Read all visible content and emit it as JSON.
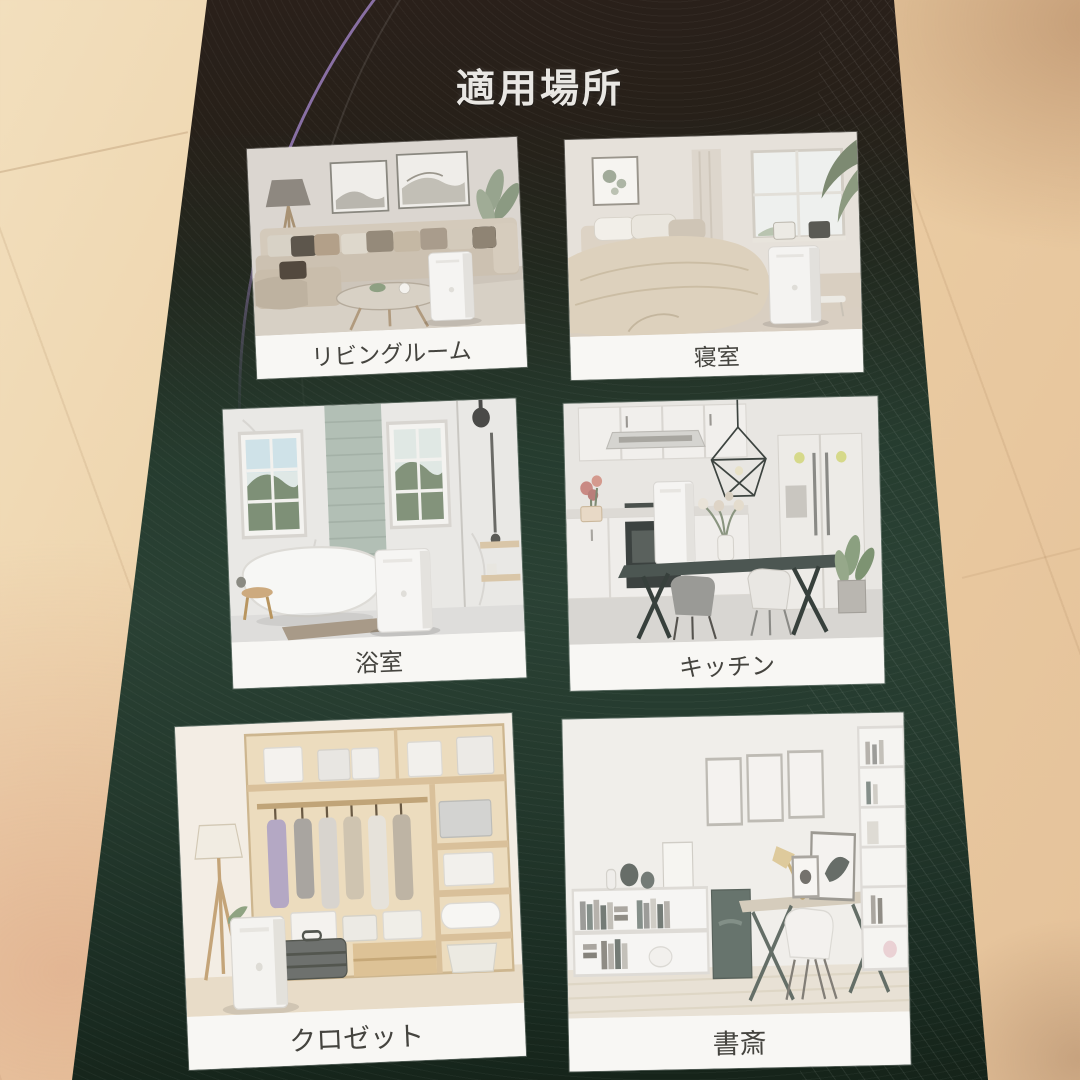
{
  "photo": {
    "title": "適用場所",
    "cards": [
      {
        "label": "リビングルーム",
        "scene": "living-room"
      },
      {
        "label": "寝室",
        "scene": "bedroom"
      },
      {
        "label": "浴室",
        "scene": "bathroom"
      },
      {
        "label": "キッチン",
        "scene": "kitchen"
      },
      {
        "label": "クロゼット",
        "scene": "closet"
      },
      {
        "label": "書斎",
        "scene": "study"
      }
    ],
    "colors": {
      "box_top_brown": "#2a201a",
      "box_green": "#2a4134",
      "accent_purple": "#a88ad2",
      "floor_wood": "#eccfa5",
      "card_background": "#f7f6f3",
      "label_text": "#45443f",
      "title_text": "#e9e7e3"
    }
  }
}
